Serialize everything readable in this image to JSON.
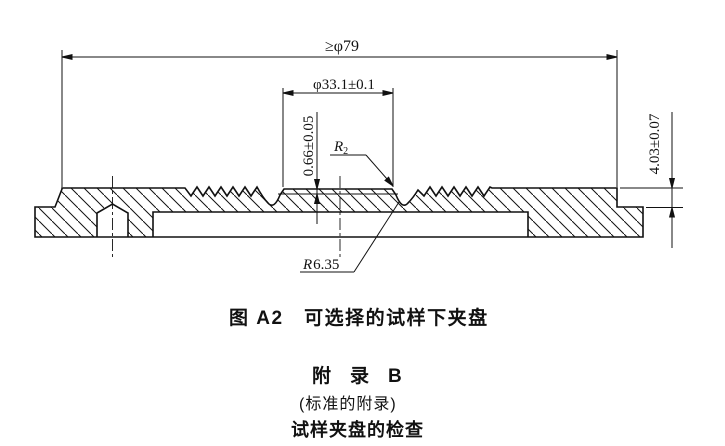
{
  "figure": {
    "dims": {
      "overall_diameter": "≥φ79",
      "plateau_diameter": "φ33.1±0.1",
      "step_height": "0.66±0.05",
      "edge_thickness": "4.03±0.07",
      "radius2_main": "R",
      "radius2_sub": "2",
      "radius635_main": "R",
      "radius635_rest": "6.35"
    },
    "caption": "图 A2　可选择的试样下夹盘"
  },
  "appendix": {
    "title": "附　录　B",
    "note": "(标准的附录)",
    "heading": "试样夹盘的检查"
  },
  "colors": {
    "ink": "#111111",
    "paper": "#ffffff"
  }
}
